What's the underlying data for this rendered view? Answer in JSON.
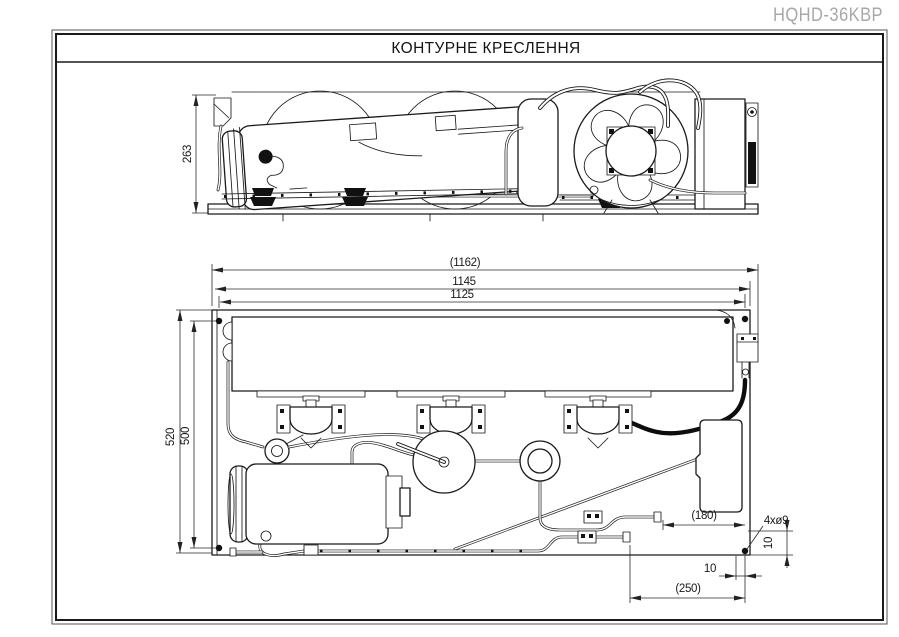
{
  "page": {
    "model": "HQHD-36KBP",
    "title": "КОНТУРНЕ КРЕСЛЕННЯ"
  },
  "dims": {
    "side_height": "263",
    "overall_length": "(1162)",
    "mount_length": "1145",
    "base_length": "1125",
    "overall_width": "520",
    "mount_width": "500",
    "pipe_offset_a": "(180)",
    "pipe_offset_b": "(250)",
    "holes_note": "4xø9",
    "hole_inset_v": "10",
    "hole_inset_h": "10"
  }
}
